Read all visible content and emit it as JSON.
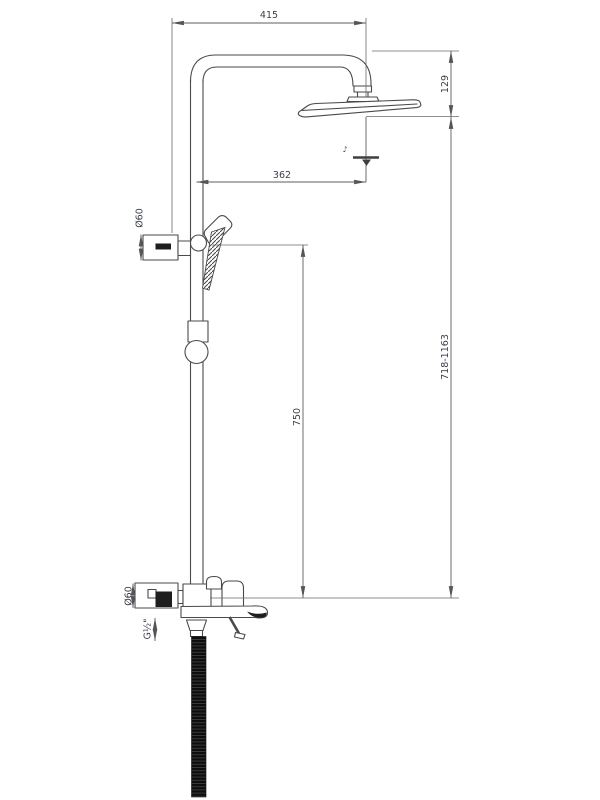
{
  "page": {
    "background": "#ffffff"
  },
  "drawing": {
    "type": "technical-drawing",
    "subject": "shower column with overhead shower, hand shower, bath spout and hose",
    "line_color": "#4a4a4a",
    "dimension_color": "#5c5c5c",
    "text_color": "#3b404c",
    "hose_color": "#0d0d0d",
    "dimensions": {
      "arm_width": "415",
      "head_drop": "129",
      "head_offset": "362",
      "upper_escutcheon_diameter": "Ø60",
      "slide_height": "750",
      "overall_height": "718-1163",
      "lower_escutcheon_diameter": "Ø60",
      "hose_thread": "G½\""
    },
    "icons": {
      "spray_mark": "♪"
    }
  }
}
